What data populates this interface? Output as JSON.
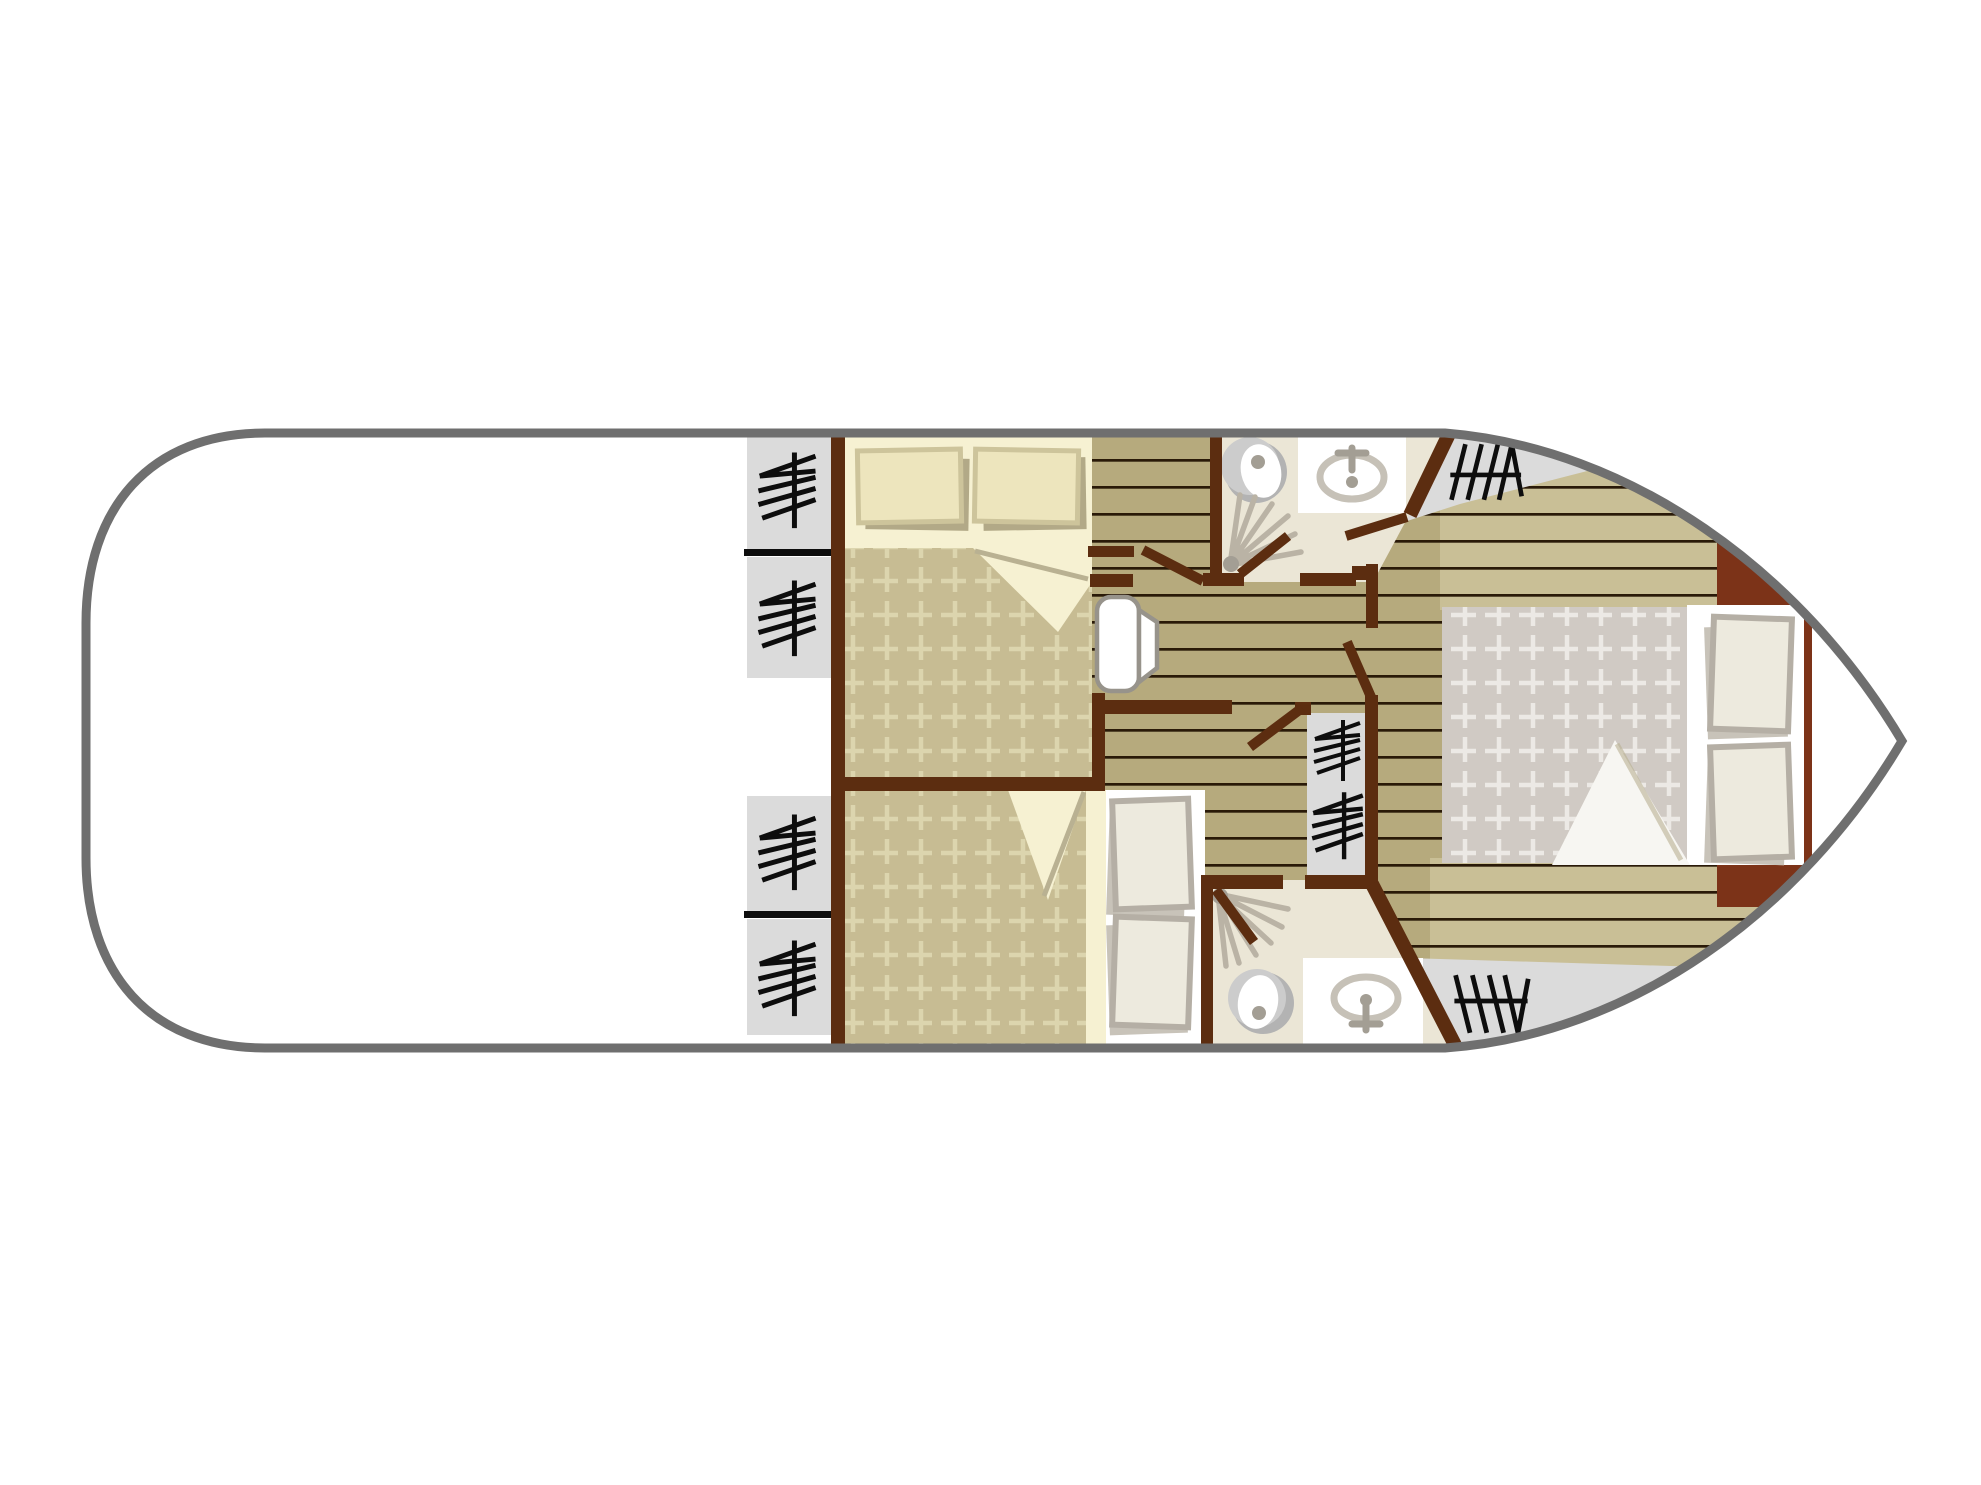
{
  "meta": {
    "title": "Boat deck floor plan (top view, bow to the right)",
    "canvas": {
      "width": 1981,
      "height": 1485,
      "background": "#ffffff"
    }
  },
  "palette": {
    "hull-stroke": "#6f6f6f",
    "sheet-white": "#ffffff",
    "wood": "#b6aa7d",
    "wood-light": "#c9bf96",
    "plank-line": "#2a1a08",
    "bath-floor": "#ebe6d6",
    "gray-area": "#dbdbdb",
    "wall": "#5c2d10",
    "mattress": "#f6f1d2",
    "blanket-khaki": "#c7bc93",
    "blanket-khaki-grid": "#dcd5ae",
    "blanket-gray": "#d0cac4",
    "blanket-gray-grid": "#ece9e5",
    "pillow-cream": "#ede5bd",
    "pillow-cream-border": "#cdc49b",
    "pillow-gray": "#edeade",
    "pillow-gray-border": "#b5afa5",
    "pillow-gray-shadow": "#c8c3b9",
    "shadow": "#b2a987",
    "fold-white": "#f7f6f2",
    "fold-line": "#b9b192",
    "headboard": "#7c3318",
    "symbol": "#0d0d0d",
    "fan": "#bab3a5",
    "fixture": "#c6c1b7",
    "fixture-dark": "#a39e94",
    "toilet-gray": "#b3b3b3",
    "toilet-light": "#cccccc",
    "door-frame": "#97938b"
  },
  "legend": {
    "hanger_symbol": "wardrobe / hanging locker",
    "steps_symbol": "steps to deck",
    "fan_symbol": "shower",
    "counts": {
      "double_beds": 3,
      "shower_rooms": 2,
      "toilets": 2,
      "washbasins": 2,
      "wardrobe_symbols": 6,
      "steps_symbols": 2
    }
  },
  "rooms": [
    {
      "id": "open-deck",
      "side": "aft (left)"
    },
    {
      "id": "cabin-upper",
      "features": [
        "double-bed",
        "two-wardrobes"
      ]
    },
    {
      "id": "cabin-lower",
      "features": [
        "double-bed",
        "two-wardrobes"
      ]
    },
    {
      "id": "shower-room-upper",
      "features": [
        "toilet",
        "washbasin",
        "shower"
      ]
    },
    {
      "id": "shower-room-lower",
      "features": [
        "toilet",
        "washbasin",
        "shower"
      ]
    },
    {
      "id": "master-cabin-bow",
      "features": [
        "double-bed",
        "headboard",
        "hallway-wardrobe"
      ]
    },
    {
      "id": "corridor",
      "features": [
        "plank-floor"
      ]
    }
  ]
}
